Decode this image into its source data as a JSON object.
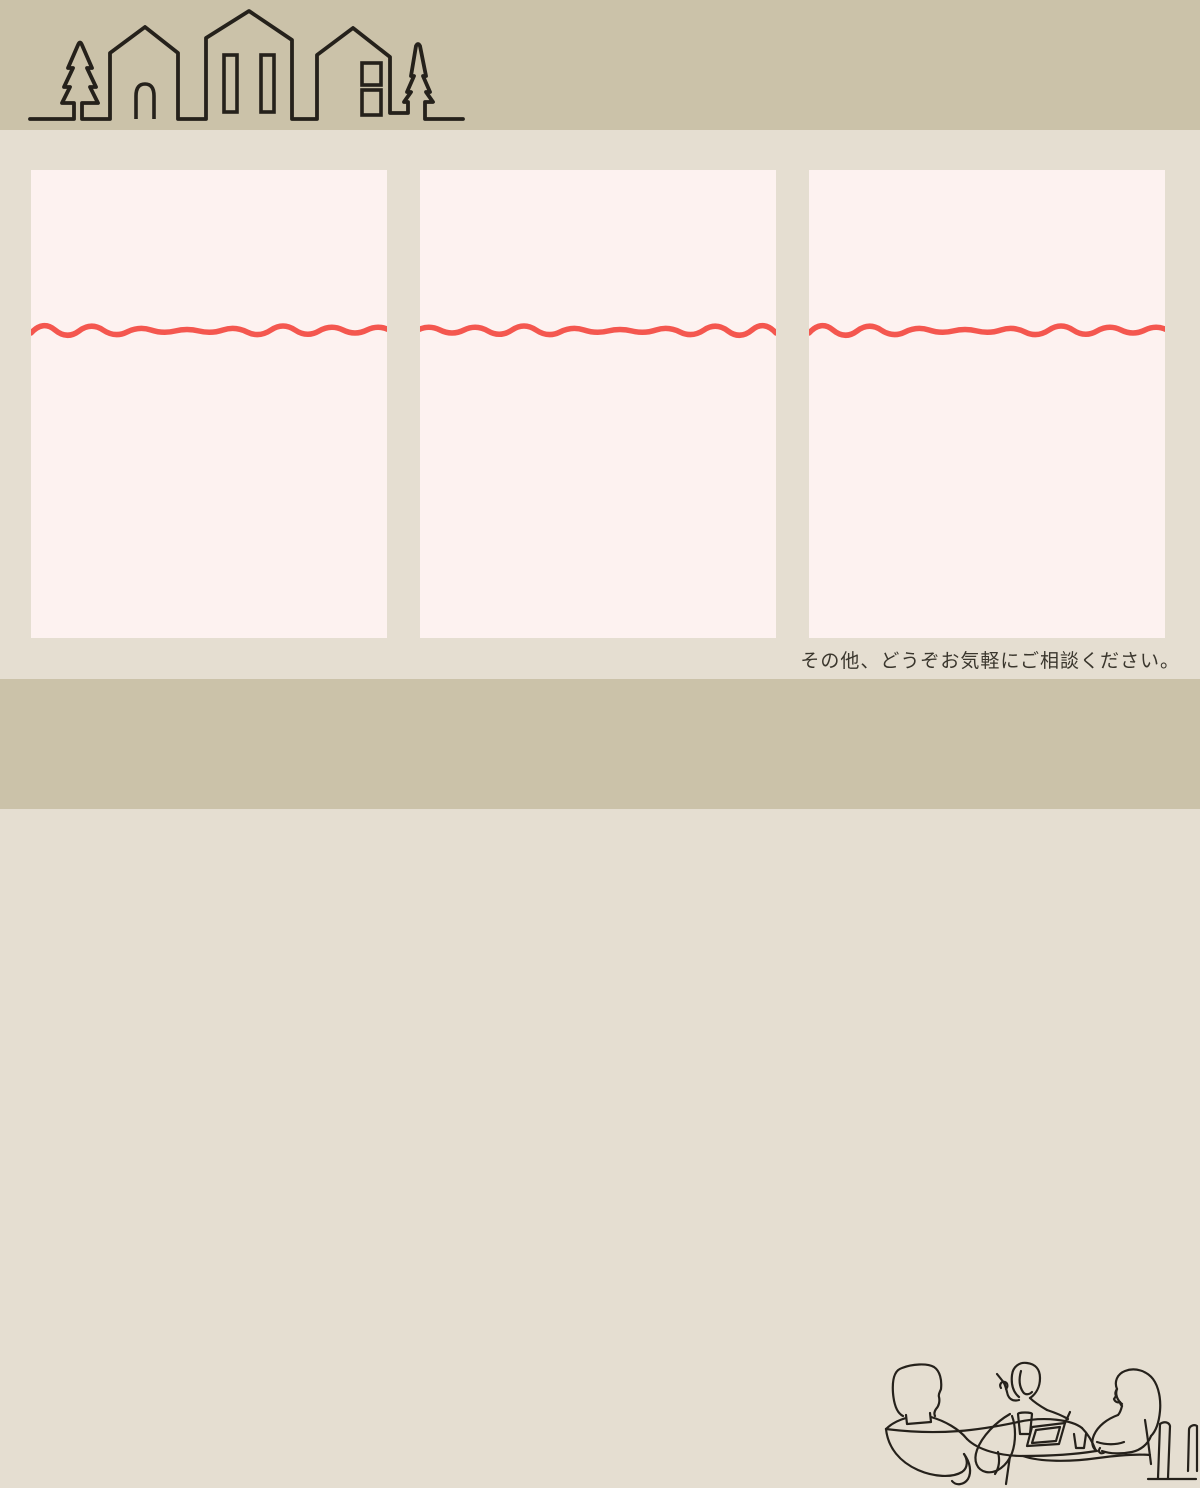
{
  "colors": {
    "band": "#cbc2a9",
    "section": "#e5ded1",
    "card": "#fdf2f0",
    "wave": "#f4574f",
    "line": "#25211b",
    "text": "#3a362d"
  },
  "header": {
    "illustration": "town-skyline-line-art"
  },
  "cards": {
    "count": 3,
    "divider": "red-wavy-line"
  },
  "footer": {
    "note": "その他、どうぞお気軽にご相談ください。",
    "illustration": "consultation-meeting-line-art"
  }
}
